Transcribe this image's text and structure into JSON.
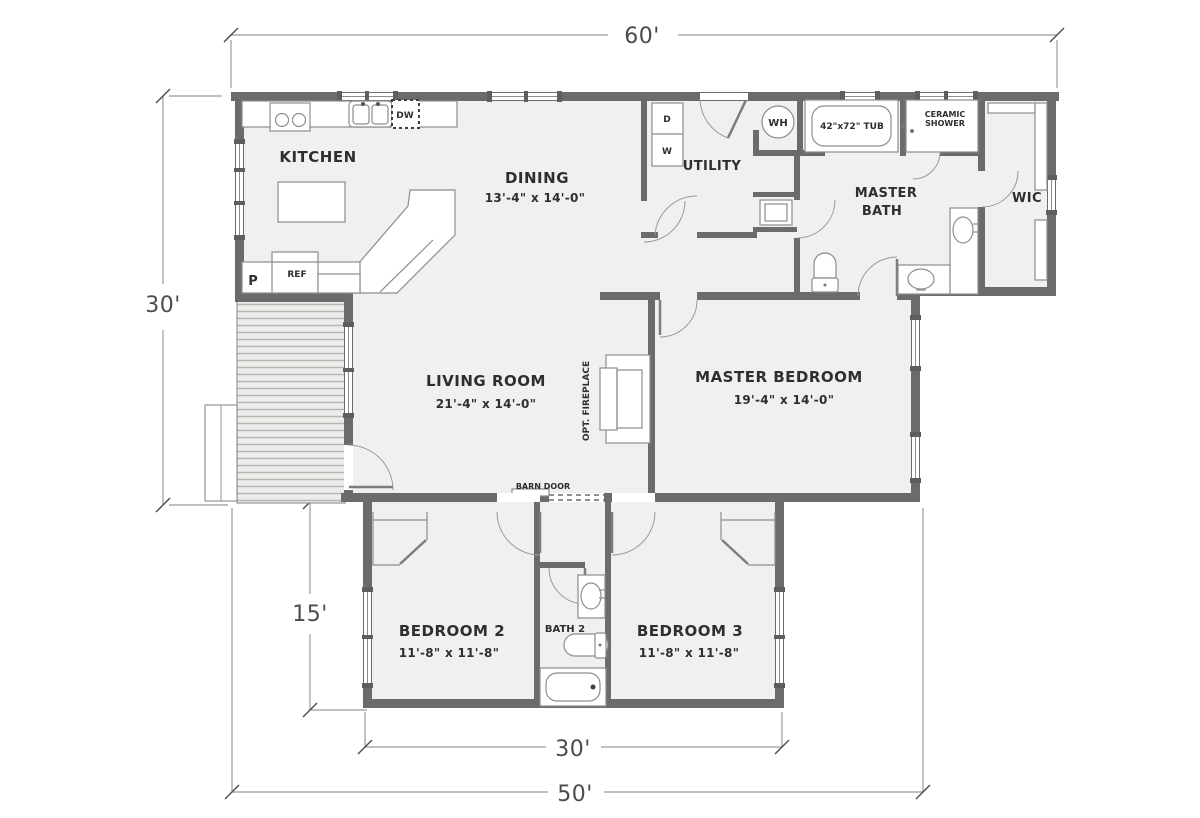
{
  "plan": {
    "dimensions": {
      "top_width": "60'",
      "left_height": "30'",
      "wing_height": "15'",
      "wing_width": "30'",
      "bottom_width": "50'"
    },
    "rooms": {
      "kitchen": {
        "name": "KITCHEN"
      },
      "dining": {
        "name": "DINING",
        "size": "13'-4\" x 14'-0\""
      },
      "utility": {
        "name": "UTILITY"
      },
      "master_bath": {
        "line1": "MASTER",
        "line2": "BATH"
      },
      "wic": {
        "name": "WIC"
      },
      "living": {
        "name": "LIVING ROOM",
        "size": "21'-4\" x 14'-0\""
      },
      "master_bedroom": {
        "name": "MASTER BEDROOM",
        "size": "19'-4\" x 14'-0\""
      },
      "bedroom2": {
        "name": "BEDROOM 2",
        "size": "11'-8\" x 11'-8\""
      },
      "bath2": {
        "name": "BATH 2"
      },
      "bedroom3": {
        "name": "BEDROOM 3",
        "size": "11'-8\" x 11'-8\""
      }
    },
    "fixtures": {
      "pantry": "P",
      "fridge": "REF",
      "dishwasher": "DW",
      "dryer": "D",
      "washer": "W",
      "water_heater": "WH",
      "tub": "42\"x72\" TUB",
      "shower_line1": "CERAMIC",
      "shower_line2": "SHOWER",
      "fireplace": "OPT. FIREPLACE",
      "barn_door": "BARN DOOR"
    },
    "colors": {
      "wall": "#6b6b6b",
      "floor": "#f1f0ee",
      "deck_stripe": "#b6b4b0",
      "dimension_line": "#9b9b9b",
      "text": "#2e2e2e"
    }
  }
}
